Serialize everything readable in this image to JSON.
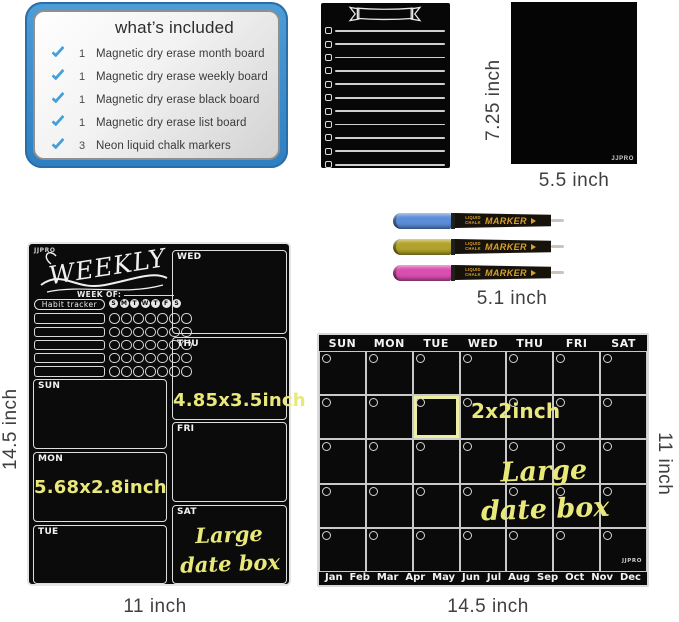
{
  "chalk_yellow": "#e9e87a",
  "included_panel": {
    "title": "what’s included",
    "check_color": "#46a0d8",
    "items": [
      {
        "qty": "1",
        "label": "Magnetic dry erase month board"
      },
      {
        "qty": "1",
        "label": "Magnetic dry erase weekly board"
      },
      {
        "qty": "1",
        "label": "Magnetic dry erase black board"
      },
      {
        "qty": "1",
        "label": "Magnetic dry erase list board"
      },
      {
        "qty": "3",
        "label": "Neon liquid chalk markers"
      }
    ]
  },
  "list_board": {
    "row_count": 11
  },
  "black_board": {
    "brand": "JJPRO",
    "height_label": "7.25 inch",
    "width_label": "5.5 inch"
  },
  "markers": {
    "length_label": "5.1 inch",
    "brand_line": "LIQUID CHALK",
    "brand_word": "MARKER",
    "items": [
      {
        "name": "blue-marker",
        "color": "#5b8ed8"
      },
      {
        "name": "yellow-marker",
        "color": "#b2a32c"
      },
      {
        "name": "pink-marker",
        "color": "#d94fb0"
      }
    ]
  },
  "weekly_board": {
    "brand": "JJPRO",
    "title": "WEEKLY",
    "week_of_label": "WEEK OF:",
    "habit_tracker_label": "Habit tracker",
    "day_initials": [
      "S",
      "M",
      "T",
      "W",
      "T",
      "F",
      "S"
    ],
    "habit_row_count": 5,
    "left_days": [
      "SUN",
      "MON",
      "TUE"
    ],
    "right_days": [
      "WED",
      "THU",
      "FRI",
      "SAT"
    ],
    "thu_note": "4.85x3.5inch",
    "mon_note": "5.68x2.8inch",
    "sat_note": [
      "Large",
      "date box"
    ],
    "height_label": "14.5 inch",
    "width_label": "11 inch"
  },
  "month_board": {
    "brand": "JJPRO",
    "day_headers": [
      "SUN",
      "MON",
      "TUE",
      "WED",
      "THU",
      "FRI",
      "SAT"
    ],
    "months": [
      "Jan",
      "Feb",
      "Mar",
      "Apr",
      "May",
      "Jun",
      "Jul",
      "Aug",
      "Sep",
      "Oct",
      "Nov",
      "Dec"
    ],
    "rows": 5,
    "cols": 7,
    "highlight_cell": {
      "row": 1,
      "col": 2
    },
    "highlight_color": "#eceea1",
    "highlight_note": "2x2inch",
    "large_note": [
      "Large",
      "date box"
    ],
    "height_label": "11 inch",
    "width_label": "14.5 inch"
  }
}
